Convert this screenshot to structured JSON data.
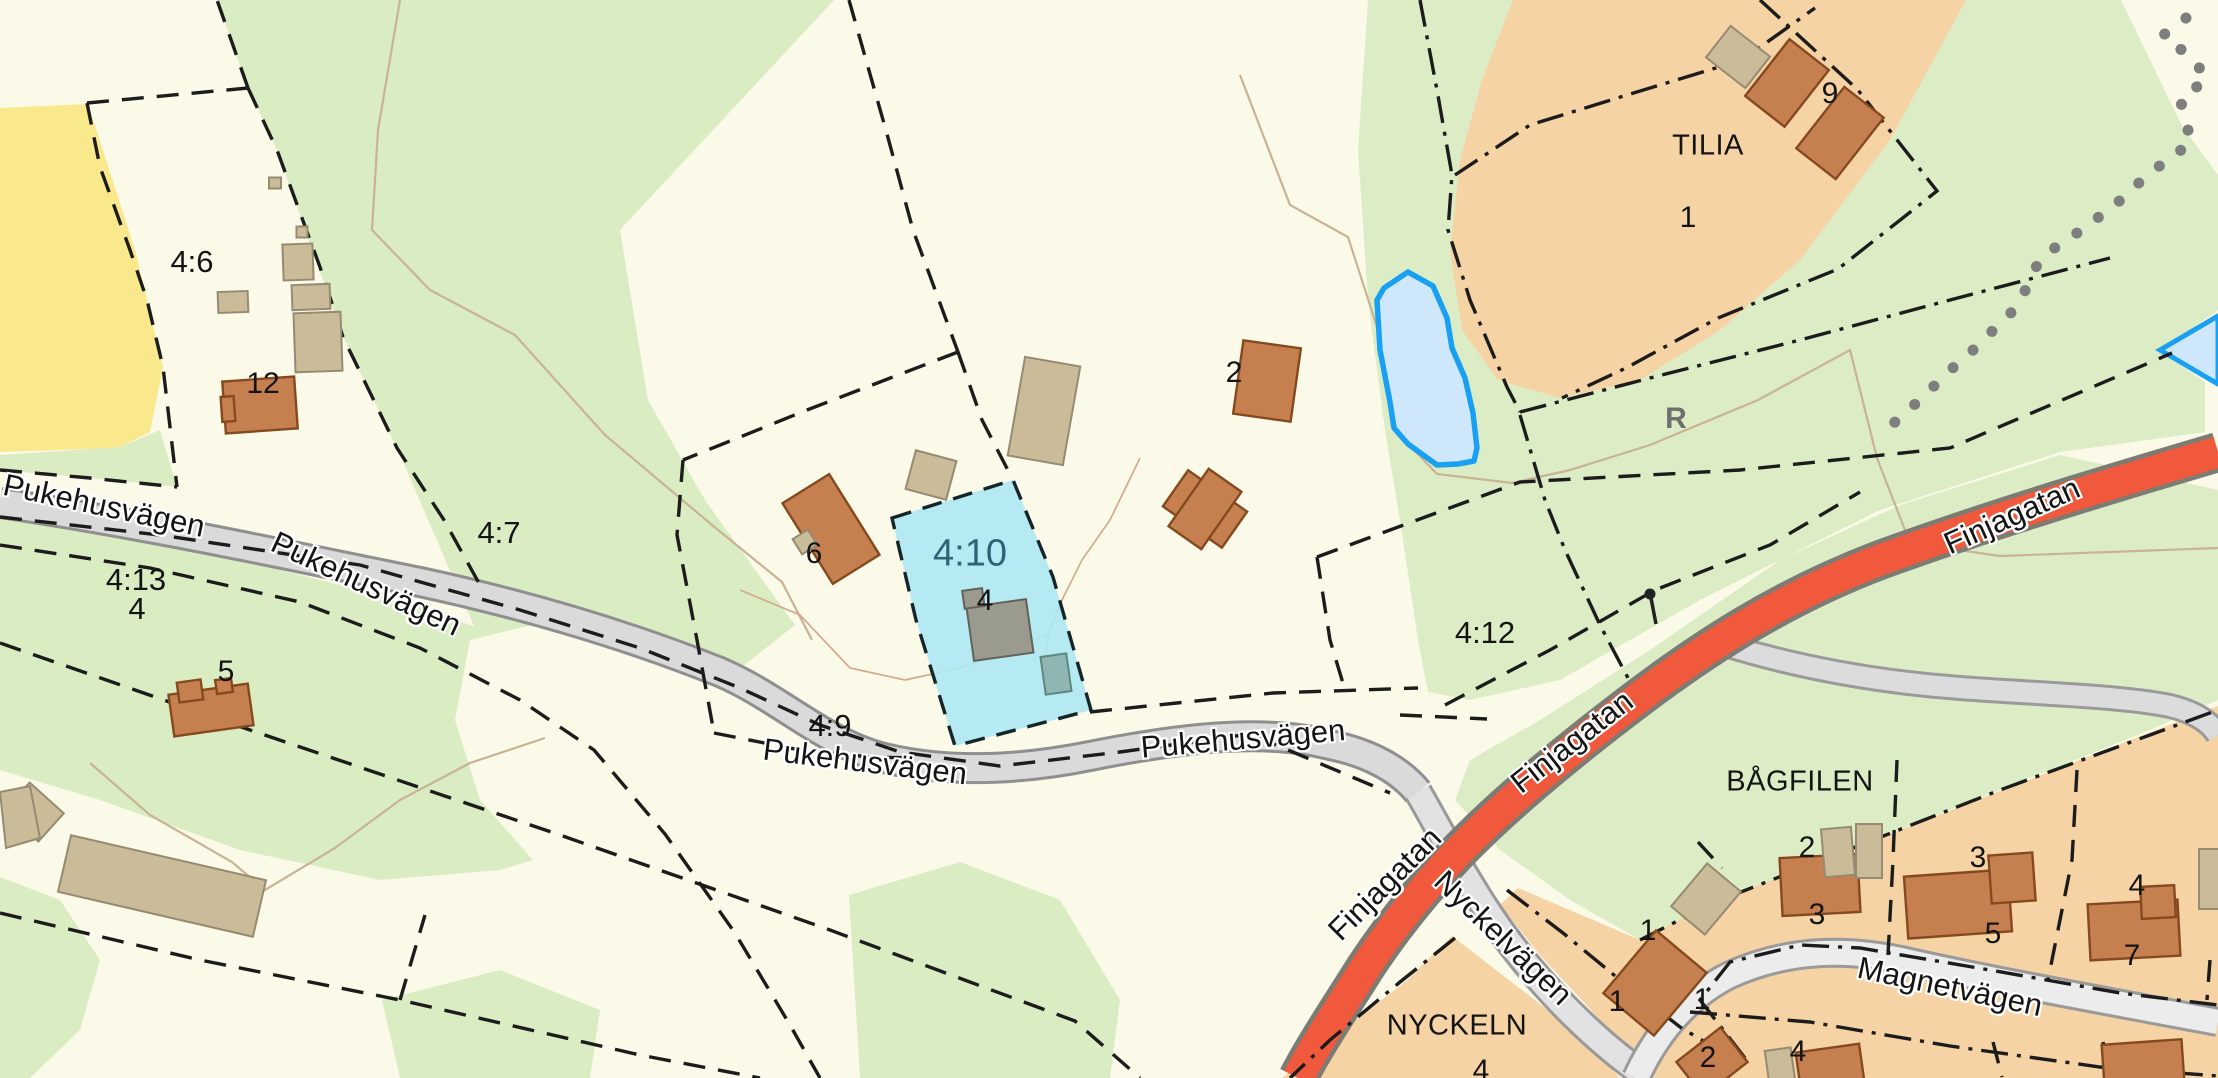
{
  "map": {
    "type": "cadastral-web-map",
    "colors": {
      "background_cream": "#fbf9e8",
      "forest_green": "#daecc2",
      "field_yellow": "#f9e88c",
      "residential_block": "#f5d3a4",
      "road_minor_fill": "#dadada",
      "road_minor_casing": "#8f8f8f",
      "road_major_fill": "#f0593c",
      "road_major_casing": "#7c7c74",
      "water_fill": "#cfe7fb",
      "water_stroke": "#1aa0f2",
      "parcel_highlight_fill": "#aee8f3",
      "parcel_highlight_text": "#2a6476",
      "house_fill": "#c6804f",
      "shed_fill": "#cabc98",
      "boundary_line": "#1c1c1c",
      "trail_dots": "#7e7e7e"
    },
    "roads": [
      "Pukehusvägen",
      "Finjagatan",
      "Nyckelvägen",
      "Magnetvägen"
    ],
    "blocks": [
      "TILIA",
      "BÅGFILEN",
      "NYCKELN"
    ],
    "parcels": [
      "4:6",
      "4:7",
      "4:13",
      "4:9",
      "4:10",
      "4:12"
    ],
    "highlighted_parcel": "4:10",
    "water_features": [
      "pond",
      "stream"
    ],
    "symbols": {
      "ancient_monument": "R",
      "survey_marker": true,
      "dotted_trail": true
    }
  },
  "labels": [
    {
      "text": "4:6",
      "x": 192,
      "y": 262,
      "rot": 0,
      "kind": "parcel"
    },
    {
      "text": "4:7",
      "x": 499,
      "y": 533,
      "rot": 0,
      "kind": "parcel"
    },
    {
      "text": "4:13",
      "x": 136,
      "y": 580,
      "rot": 0,
      "kind": "parcel"
    },
    {
      "text": "4",
      "x": 137,
      "y": 609,
      "rot": 0,
      "kind": "parcel"
    },
    {
      "text": "4:9",
      "x": 830,
      "y": 726,
      "rot": 0,
      "kind": "parcel"
    },
    {
      "text": "4:12",
      "x": 1485,
      "y": 633,
      "rot": 0,
      "kind": "parcel"
    },
    {
      "text": "4:10",
      "x": 970,
      "y": 554,
      "rot": 0,
      "kind": "parcel-hl"
    },
    {
      "text": "12",
      "x": 263,
      "y": 384,
      "rot": 0,
      "kind": "house"
    },
    {
      "text": "5",
      "x": 226,
      "y": 672,
      "rot": 0,
      "kind": "house"
    },
    {
      "text": "6",
      "x": 814,
      "y": 554,
      "rot": 0,
      "kind": "house"
    },
    {
      "text": "4",
      "x": 985,
      "y": 601,
      "rot": 0,
      "kind": "house"
    },
    {
      "text": "2",
      "x": 1234,
      "y": 373,
      "rot": 0,
      "kind": "house"
    },
    {
      "text": "9",
      "x": 1830,
      "y": 94,
      "rot": 0,
      "kind": "house"
    },
    {
      "text": "1",
      "x": 1688,
      "y": 218,
      "rot": 0,
      "kind": "house"
    },
    {
      "text": "2",
      "x": 1807,
      "y": 848,
      "rot": 0,
      "kind": "house"
    },
    {
      "text": "3",
      "x": 1817,
      "y": 915,
      "rot": 0,
      "kind": "house"
    },
    {
      "text": "3",
      "x": 1978,
      "y": 858,
      "rot": 0,
      "kind": "house"
    },
    {
      "text": "5",
      "x": 1993,
      "y": 934,
      "rot": 0,
      "kind": "house"
    },
    {
      "text": "4",
      "x": 2137,
      "y": 886,
      "rot": 0,
      "kind": "house"
    },
    {
      "text": "7",
      "x": 2132,
      "y": 956,
      "rot": 0,
      "kind": "house"
    },
    {
      "text": "1",
      "x": 1648,
      "y": 931,
      "rot": 0,
      "kind": "house"
    },
    {
      "text": "1",
      "x": 1702,
      "y": 1000,
      "rot": 0,
      "kind": "house"
    },
    {
      "text": "1",
      "x": 1617,
      "y": 1002,
      "rot": 0,
      "kind": "house"
    },
    {
      "text": "2",
      "x": 1708,
      "y": 1058,
      "rot": 0,
      "kind": "house"
    },
    {
      "text": "4",
      "x": 1798,
      "y": 1052,
      "rot": 0,
      "kind": "house"
    },
    {
      "text": "4",
      "x": 1481,
      "y": 1071,
      "rot": 0,
      "kind": "house"
    },
    {
      "text": "TILIA",
      "x": 1708,
      "y": 146,
      "rot": 0,
      "kind": "block"
    },
    {
      "text": "BÅGFILEN",
      "x": 1800,
      "y": 782,
      "rot": 0,
      "kind": "block"
    },
    {
      "text": "NYCKELN",
      "x": 1457,
      "y": 1026,
      "rot": 0,
      "kind": "block"
    },
    {
      "text": "Pukehusvägen",
      "x": 104,
      "y": 506,
      "rot": 12,
      "kind": "road"
    },
    {
      "text": "Pukehusvägen",
      "x": 366,
      "y": 584,
      "rot": 25,
      "kind": "road"
    },
    {
      "text": "Pukehusvägen",
      "x": 865,
      "y": 762,
      "rot": 7,
      "kind": "road"
    },
    {
      "text": "Pukehusvägen",
      "x": 1243,
      "y": 739,
      "rot": -5,
      "kind": "road"
    },
    {
      "text": "Finjagatan",
      "x": 2012,
      "y": 516,
      "rot": -24,
      "kind": "road"
    },
    {
      "text": "Finjagatan",
      "x": 1572,
      "y": 742,
      "rot": -38,
      "kind": "road"
    },
    {
      "text": "Finjagatan",
      "x": 1385,
      "y": 884,
      "rot": -45,
      "kind": "road"
    },
    {
      "text": "Nyckelvägen",
      "x": 1503,
      "y": 938,
      "rot": 44,
      "kind": "road"
    },
    {
      "text": "Magnetvägen",
      "x": 1950,
      "y": 987,
      "rot": 12,
      "kind": "road"
    },
    {
      "text": "R",
      "x": 1676,
      "y": 419,
      "rot": 0,
      "kind": "rune"
    }
  ]
}
